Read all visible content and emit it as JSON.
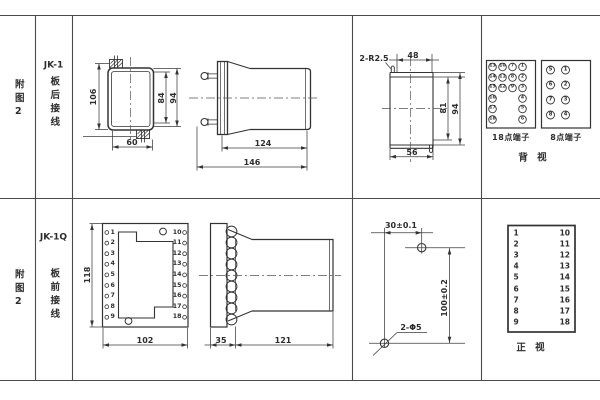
{
  "colors": {
    "line": "#3c3c3c",
    "grid": "#4a4a4a",
    "text": "#2d2d2d",
    "bg": "#ffffff"
  },
  "rows": [
    {
      "figure": "附图2",
      "model": "JK-1",
      "wiring": "板后接线"
    },
    {
      "figure": "附图2",
      "model": "JK-1Q",
      "wiring": "板前接线"
    }
  ],
  "top": {
    "dims": {
      "h106": "106",
      "h84": "84",
      "h94": "94",
      "w60": "60",
      "l124": "124",
      "l146": "146",
      "r": "2-R2.5",
      "w48": "48",
      "h81": "81",
      "h94b": "94",
      "w56": "56"
    },
    "rear18": {
      "title": "18点端子",
      "rows": [
        [
          "13",
          "10",
          "7",
          "1"
        ],
        [
          "14",
          "11",
          "8",
          "2"
        ],
        [
          "15",
          "12",
          "9",
          "3"
        ],
        [
          "16",
          "4"
        ],
        [
          "17",
          "5"
        ],
        [
          "18",
          "6"
        ]
      ]
    },
    "rear8": {
      "title": "8点端子",
      "rows": [
        [
          "5",
          "1"
        ],
        [
          "6",
          "2"
        ],
        [
          "7",
          "3"
        ],
        [
          "8",
          "4"
        ]
      ]
    },
    "view": "背 视"
  },
  "bottom": {
    "dims": {
      "h118": "118",
      "w102": "102",
      "d35": "35",
      "l121": "121",
      "dx30": "30±0.1",
      "dy100": "100±0.2",
      "holes": "2-Φ5"
    },
    "front_terms": {
      "left": [
        "1",
        "2",
        "3",
        "4",
        "5",
        "6",
        "7",
        "8",
        "9"
      ],
      "right": [
        "10",
        "11",
        "12",
        "13",
        "14",
        "15",
        "16",
        "17",
        "18"
      ]
    },
    "table": {
      "left": [
        "1",
        "2",
        "3",
        "4",
        "5",
        "6",
        "7",
        "8",
        "9"
      ],
      "right": [
        "10",
        "11",
        "12",
        "13",
        "14",
        "15",
        "16",
        "17",
        "18"
      ]
    },
    "view": "正 视"
  }
}
